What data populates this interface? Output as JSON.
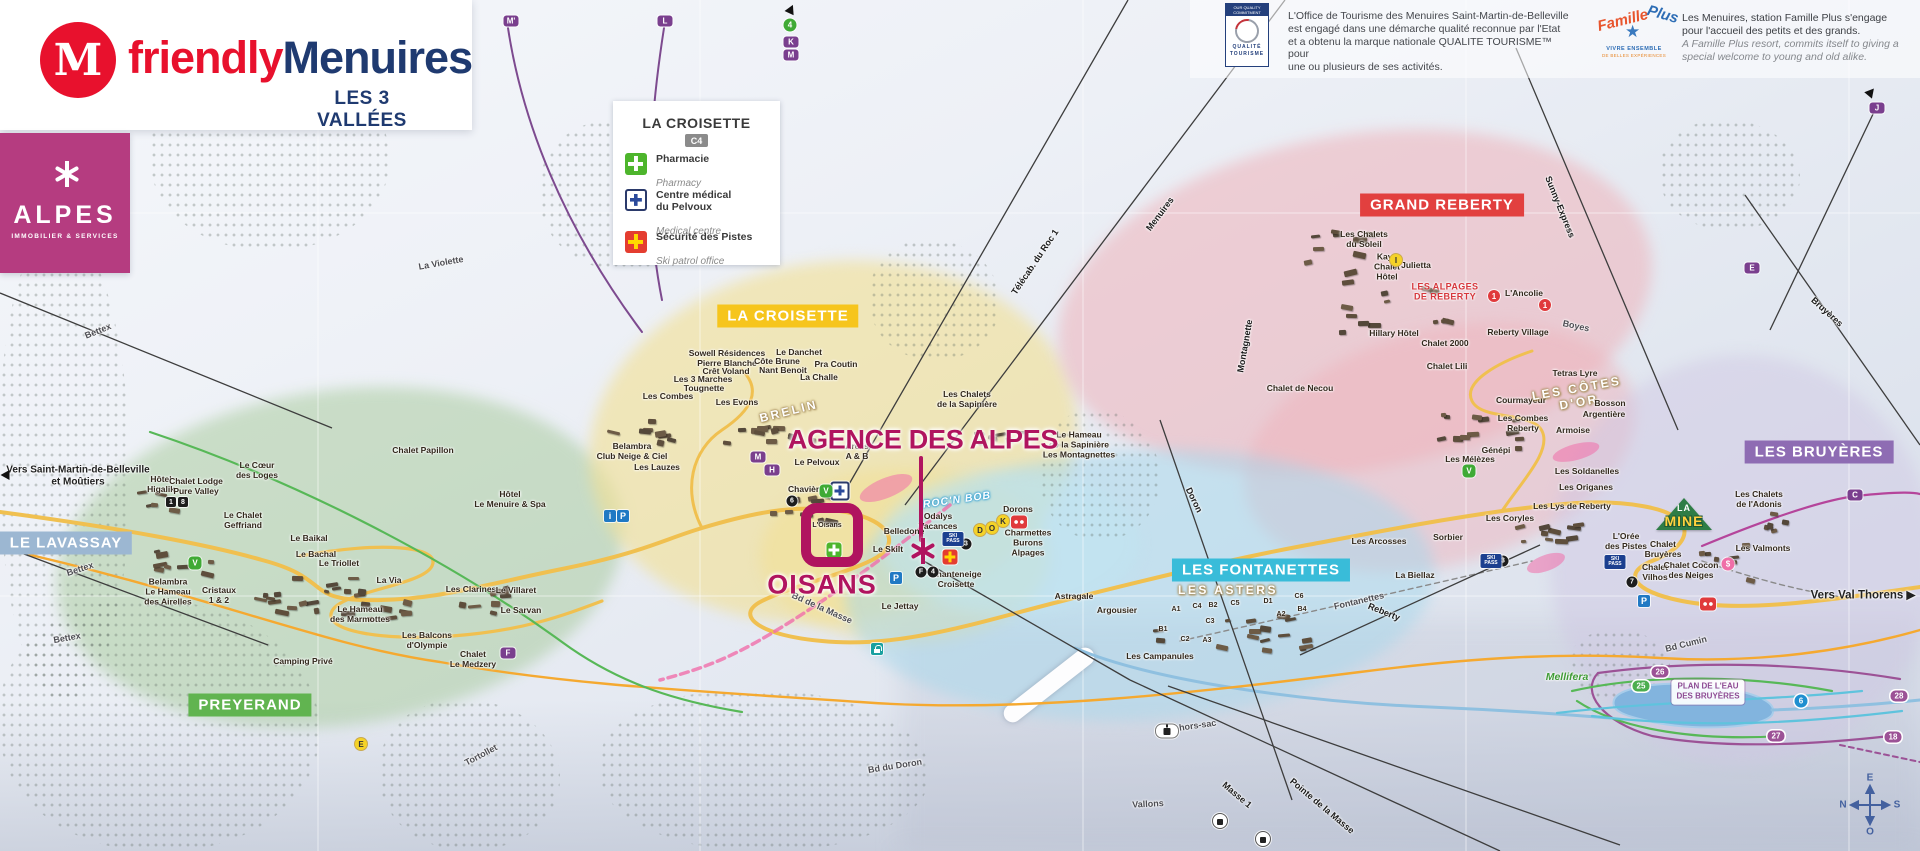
{
  "header": {
    "brand_icon": "M",
    "brand_red": "friendly",
    "brand_blue": "Menuires",
    "tagline": "LES 3 VALLÉES"
  },
  "alpes": {
    "name": "ALPES",
    "sub": "IMMOBILIER & SERVICES"
  },
  "legend": {
    "title": "LA CROISETTE",
    "ref": "C4",
    "items": [
      {
        "label": "Pharmacie",
        "sub": "Pharmacy"
      },
      {
        "label": "Centre médical\ndu Pelvoux",
        "sub": "Medical centre"
      },
      {
        "label": "Sécurité des Pistes",
        "sub": "Ski patrol office"
      }
    ]
  },
  "quality": {
    "logo_top": "OUR QUALITY\nCOMMITMENT",
    "logo_bottom": "QUALITÉ\nTOURISME",
    "text": "L'Office de Tourisme des Menuires Saint-Martin-de-Belleville\nest engagé dans une démarche qualité reconnue par l'Etat\net a obtenu la marque nationale QUALITE TOURISME™ pour\nune ou plusieurs de ses activités."
  },
  "famille": {
    "arc1": "Famille",
    "arc2": "Plus",
    "star": "★",
    "sub1": "VIVRE ENSEMBLE",
    "sub2": "DE BELLES EXPÉRIENCES",
    "fr": "Les Menuires, station Famille Plus s'engage\npour l'accueil des petits et des grands.",
    "en": "A Famille Plus resort, commits itself to giving a\nspecial welcome to young and old alike."
  },
  "callout": {
    "agency": "AGENCE DES ALPES",
    "residence": "OISANS"
  },
  "la_mine": {
    "l1": "LA",
    "l2": "MINE"
  },
  "plan_eau": {
    "t": "PLAN DE L'EAU\nDES BRUYÈRES"
  },
  "compass": {
    "top": "E",
    "right": "S",
    "bottom": "O",
    "left": "N"
  },
  "map": {
    "regions": [
      {
        "t": "LA CROISETTE",
        "x": 788,
        "y": 316,
        "bg": "#f6c51d"
      },
      {
        "t": "GRAND REBERTY",
        "x": 1442,
        "y": 205,
        "bg": "#e2403f"
      },
      {
        "t": "LES BRUYÈRES",
        "x": 1819,
        "y": 452,
        "bg": "#8e6cb3"
      },
      {
        "t": "LES FONTANETTES",
        "x": 1261,
        "y": 570,
        "bg": "#39bcd9"
      },
      {
        "t": "PREYERAND",
        "x": 250,
        "y": 705,
        "bg": "#61b450"
      },
      {
        "t": "LE LAVASSAY",
        "x": 66,
        "y": 543,
        "bg": "#9cb7d2"
      }
    ],
    "labels": [
      {
        "t": "Vers Saint-Martin-de-Belleville\net Moûtiers",
        "x": 78,
        "y": 476,
        "c": "dest",
        "s": 10
      },
      {
        "t": "Vers Val Thorens ▶",
        "x": 1863,
        "y": 596,
        "c": "dest"
      },
      {
        "t": "Hôtel\nHigalik",
        "x": 161,
        "y": 485
      },
      {
        "t": "Chalet Lodge\nPure Valley",
        "x": 196,
        "y": 487
      },
      {
        "t": "Le Cœur\ndes Loges",
        "x": 257,
        "y": 471
      },
      {
        "t": "Le Chalet\nGeffriand",
        "x": 243,
        "y": 521
      },
      {
        "t": "Le Baikal",
        "x": 309,
        "y": 539
      },
      {
        "t": "Belambra\nLe Hameau\ndes Airelles",
        "x": 168,
        "y": 592
      },
      {
        "t": "Cristaux\n1 & 2",
        "x": 219,
        "y": 596
      },
      {
        "t": "Le Bachal",
        "x": 316,
        "y": 555
      },
      {
        "t": "Le Triollet",
        "x": 339,
        "y": 564
      },
      {
        "t": "La Via",
        "x": 389,
        "y": 581
      },
      {
        "t": "Le Hameau\ndes Marmottes",
        "x": 360,
        "y": 615
      },
      {
        "t": "Les Balcons\nd'Olympie",
        "x": 427,
        "y": 641
      },
      {
        "t": "Chalet\nLe Medzery",
        "x": 473,
        "y": 660
      },
      {
        "t": "Les Clarines",
        "x": 471,
        "y": 590
      },
      {
        "t": "Le Villaret",
        "x": 516,
        "y": 591
      },
      {
        "t": "Le Sarvan",
        "x": 521,
        "y": 611
      },
      {
        "t": "Camping Privé",
        "x": 303,
        "y": 662
      },
      {
        "t": "Chalet Papillon",
        "x": 423,
        "y": 451
      },
      {
        "t": "Hôtel\nLe Menuire & Spa",
        "x": 510,
        "y": 500
      },
      {
        "t": "Belambra\nClub Neige & Ciel",
        "x": 632,
        "y": 452
      },
      {
        "t": "Les Lauzes",
        "x": 657,
        "y": 468
      },
      {
        "t": "Sowell Résidences\nPierre Blanche",
        "x": 727,
        "y": 359
      },
      {
        "t": "Crêt Voland",
        "x": 726,
        "y": 372
      },
      {
        "t": "Les 3 Marches",
        "x": 703,
        "y": 380
      },
      {
        "t": "Tougnette",
        "x": 704,
        "y": 389
      },
      {
        "t": "Les Combes",
        "x": 668,
        "y": 397
      },
      {
        "t": "Les Evons",
        "x": 737,
        "y": 403
      },
      {
        "t": "Le Danchet",
        "x": 799,
        "y": 353
      },
      {
        "t": "Côte Brune",
        "x": 777,
        "y": 362
      },
      {
        "t": "Nant Benoit",
        "x": 783,
        "y": 371
      },
      {
        "t": "Pra Coutin",
        "x": 836,
        "y": 365
      },
      {
        "t": "La Challe",
        "x": 819,
        "y": 378
      },
      {
        "t": "BRELIN",
        "x": 789,
        "y": 412,
        "c": "outline",
        "r": -14
      },
      {
        "t": "Le Pelvoux",
        "x": 817,
        "y": 463
      },
      {
        "t": "Arelis\nA & B",
        "x": 857,
        "y": 452
      },
      {
        "t": "Chavière",
        "x": 806,
        "y": 490
      },
      {
        "t": "L'Oisans",
        "x": 827,
        "y": 526,
        "s": 7
      },
      {
        "t": "Odalys\nVacances",
        "x": 938,
        "y": 522
      },
      {
        "t": "ROC'N BOB",
        "x": 957,
        "y": 500,
        "c": "bluestroke",
        "r": -8
      },
      {
        "t": "Dorons",
        "x": 1018,
        "y": 510
      },
      {
        "t": "Charmettes\nBurons\nAlpages",
        "x": 1028,
        "y": 543
      },
      {
        "t": "Chanteneige\nCroisette",
        "x": 956,
        "y": 580
      },
      {
        "t": "Belledone",
        "x": 904,
        "y": 532
      },
      {
        "t": "Le Skilt",
        "x": 888,
        "y": 550
      },
      {
        "t": "Le Jettay",
        "x": 900,
        "y": 607
      },
      {
        "t": "Astragale",
        "x": 1074,
        "y": 597
      },
      {
        "t": "Argousier",
        "x": 1117,
        "y": 611
      },
      {
        "t": "Les Campanules",
        "x": 1160,
        "y": 657
      },
      {
        "t": "Salle hors-sac",
        "x": 1186,
        "y": 727,
        "c": "road",
        "r": -8
      },
      {
        "t": "LES ASTERS",
        "x": 1228,
        "y": 591,
        "c": "outline"
      },
      {
        "t": "Les Arcosses",
        "x": 1379,
        "y": 542
      },
      {
        "t": "La Biellaz",
        "x": 1415,
        "y": 576
      },
      {
        "t": "Le Hameau\nde la Sapinière\nLes Montagnettes",
        "x": 1079,
        "y": 445
      },
      {
        "t": "Les Chalets\nde la Sapinière",
        "x": 967,
        "y": 400
      },
      {
        "t": "Les Chalets\ndu Soleil",
        "x": 1364,
        "y": 240
      },
      {
        "t": "Kaya\nChalet\nHôtel",
        "x": 1387,
        "y": 267
      },
      {
        "t": "Julietta",
        "x": 1416,
        "y": 266
      },
      {
        "t": "LES ALPAGES\nDE REBERTY",
        "x": 1445,
        "y": 292,
        "c": "red"
      },
      {
        "t": "L'Ancolie",
        "x": 1524,
        "y": 294
      },
      {
        "t": "Hillary Hôtel",
        "x": 1394,
        "y": 334
      },
      {
        "t": "Chalet 2000",
        "x": 1445,
        "y": 344
      },
      {
        "t": "Reberty Village",
        "x": 1518,
        "y": 333
      },
      {
        "t": "Chalet Lili",
        "x": 1447,
        "y": 367
      },
      {
        "t": "Chalet de Necou",
        "x": 1300,
        "y": 389
      },
      {
        "t": "Tetras Lyre",
        "x": 1575,
        "y": 374
      },
      {
        "t": "Courmayeur",
        "x": 1521,
        "y": 401
      },
      {
        "t": "LES CÔTES\nD'OR",
        "x": 1578,
        "y": 396,
        "c": "outline",
        "r": -10
      },
      {
        "t": "Bosson",
        "x": 1610,
        "y": 404
      },
      {
        "t": "Argentière",
        "x": 1604,
        "y": 415
      },
      {
        "t": "Les Combes\nReberty",
        "x": 1523,
        "y": 424
      },
      {
        "t": "Armoise",
        "x": 1573,
        "y": 431
      },
      {
        "t": "Génépi",
        "x": 1496,
        "y": 451
      },
      {
        "t": "Les Mélèzes",
        "x": 1470,
        "y": 460
      },
      {
        "t": "Les Soldanelles",
        "x": 1587,
        "y": 472
      },
      {
        "t": "Les Origanes",
        "x": 1586,
        "y": 488
      },
      {
        "t": "Les Lys de Reberty",
        "x": 1572,
        "y": 507
      },
      {
        "t": "Les Coryles",
        "x": 1510,
        "y": 519
      },
      {
        "t": "Sorbier",
        "x": 1448,
        "y": 538
      },
      {
        "t": "L'Orée\ndes Pistes",
        "x": 1626,
        "y": 542
      },
      {
        "t": "Chalet\nBruyères",
        "x": 1663,
        "y": 550
      },
      {
        "t": "Chalet\nVilhos",
        "x": 1655,
        "y": 573
      },
      {
        "t": "Chalet Cocon\ndes Neiges",
        "x": 1691,
        "y": 571
      },
      {
        "t": "Les Chalets\nde l'Adonis",
        "x": 1759,
        "y": 500
      },
      {
        "t": "Les Valmonts",
        "x": 1763,
        "y": 549
      },
      {
        "t": "Mellifera",
        "x": 1567,
        "y": 677,
        "c": "green"
      },
      {
        "t": "A1",
        "x": 1176,
        "y": 610,
        "c": "tiny"
      },
      {
        "t": "C4",
        "x": 1197,
        "y": 607,
        "c": "tiny"
      },
      {
        "t": "B2",
        "x": 1213,
        "y": 606,
        "c": "tiny"
      },
      {
        "t": "C5",
        "x": 1235,
        "y": 604,
        "c": "tiny"
      },
      {
        "t": "D1",
        "x": 1268,
        "y": 602,
        "c": "tiny"
      },
      {
        "t": "C6",
        "x": 1299,
        "y": 597,
        "c": "tiny"
      },
      {
        "t": "A2",
        "x": 1281,
        "y": 615,
        "c": "tiny"
      },
      {
        "t": "B4",
        "x": 1302,
        "y": 610,
        "c": "tiny"
      },
      {
        "t": "C3",
        "x": 1210,
        "y": 622,
        "c": "tiny"
      },
      {
        "t": "B1",
        "x": 1163,
        "y": 630,
        "c": "tiny"
      },
      {
        "t": "C2",
        "x": 1185,
        "y": 640,
        "c": "tiny"
      },
      {
        "t": "A3",
        "x": 1207,
        "y": 641,
        "c": "tiny"
      },
      {
        "t": "La Violette",
        "x": 441,
        "y": 263,
        "c": "road",
        "r": -10
      },
      {
        "t": "Bettex",
        "x": 98,
        "y": 331,
        "c": "road",
        "r": -22
      },
      {
        "t": "Bettex",
        "x": 80,
        "y": 569,
        "c": "road",
        "r": -18
      },
      {
        "t": "Bettex",
        "x": 67,
        "y": 638,
        "c": "road",
        "r": -10
      },
      {
        "t": "Tortollet",
        "x": 481,
        "y": 755,
        "c": "road",
        "r": -28
      },
      {
        "t": "Bd du Doron",
        "x": 895,
        "y": 766,
        "c": "road",
        "r": -9
      },
      {
        "t": "Vallons",
        "x": 1148,
        "y": 804,
        "c": "road",
        "r": -3
      },
      {
        "t": "Bd Cumin",
        "x": 1686,
        "y": 644,
        "c": "road",
        "r": -14
      },
      {
        "t": "Bd de la Masse",
        "x": 822,
        "y": 608,
        "c": "road",
        "r": 24
      },
      {
        "t": "Boyes",
        "x": 1576,
        "y": 326,
        "c": "road",
        "r": 12
      },
      {
        "t": "Bruyères",
        "x": 1827,
        "y": 312,
        "c": "lift",
        "r": 42
      },
      {
        "t": "Sunny-Express",
        "x": 1560,
        "y": 207,
        "c": "lift",
        "r": 68
      },
      {
        "t": "Menuires",
        "x": 1160,
        "y": 214,
        "c": "lift",
        "r": -53
      },
      {
        "t": "Télécab. du Roc 1",
        "x": 1035,
        "y": 262,
        "c": "lift",
        "r": -56
      },
      {
        "t": "Montagnette",
        "x": 1245,
        "y": 346,
        "c": "lift",
        "r": -80
      },
      {
        "t": "Doron",
        "x": 1194,
        "y": 500,
        "c": "lift",
        "r": 64
      },
      {
        "t": "Masse 1",
        "x": 1237,
        "y": 795,
        "c": "lift",
        "r": 40
      },
      {
        "t": "Pointe de la Masse",
        "x": 1322,
        "y": 806,
        "c": "lift",
        "r": 40
      },
      {
        "t": "Fontanettes",
        "x": 1359,
        "y": 601,
        "c": "road",
        "r": -13
      },
      {
        "t": "Reberty",
        "x": 1384,
        "y": 612,
        "c": "lift",
        "r": 22
      }
    ],
    "badges": [
      {
        "t": "M'",
        "x": 511,
        "y": 21,
        "k": "pp"
      },
      {
        "t": "L",
        "x": 665,
        "y": 21,
        "k": "pp"
      },
      {
        "t": "4",
        "x": 790,
        "y": 25,
        "k": "cg"
      },
      {
        "t": "K",
        "x": 791,
        "y": 42,
        "k": "pp"
      },
      {
        "t": "M",
        "x": 791,
        "y": 55,
        "k": "pp"
      },
      {
        "t": "",
        "x": 791,
        "y": 9,
        "k": "tri",
        "r": 25
      },
      {
        "t": "J",
        "x": 1877,
        "y": 108,
        "k": "pp"
      },
      {
        "t": "",
        "x": 1871,
        "y": 92,
        "k": "tri",
        "r": 40
      },
      {
        "t": "E",
        "x": 1752,
        "y": 268,
        "k": "pp"
      },
      {
        "t": "F",
        "x": 508,
        "y": 653,
        "k": "pp"
      },
      {
        "t": "C",
        "x": 1855,
        "y": 495,
        "k": "pp"
      },
      {
        "t": "M",
        "x": 758,
        "y": 457,
        "k": "pp"
      },
      {
        "t": "H",
        "x": 772,
        "y": 470,
        "k": "pp"
      },
      {
        "t": "",
        "x": 5,
        "y": 475,
        "k": "tri",
        "r": -90
      },
      {
        "t": "D",
        "x": 980,
        "y": 530,
        "k": "cy"
      },
      {
        "t": "O",
        "x": 992,
        "y": 528,
        "k": "cy"
      },
      {
        "t": "K",
        "x": 1003,
        "y": 521,
        "k": "cy"
      },
      {
        "t": "E",
        "x": 361,
        "y": 744,
        "k": "cy"
      },
      {
        "t": "I",
        "x": 1396,
        "y": 260,
        "k": "cy"
      },
      {
        "t": "1",
        "x": 1494,
        "y": 296,
        "k": "cr"
      },
      {
        "t": "1",
        "x": 1545,
        "y": 305,
        "k": "cr"
      },
      {
        "t": "3",
        "x": 966,
        "y": 544,
        "k": "cb"
      },
      {
        "t": "F",
        "x": 921,
        "y": 572,
        "k": "cb"
      },
      {
        "t": "4",
        "x": 933,
        "y": 572,
        "k": "cb"
      },
      {
        "t": "6",
        "x": 792,
        "y": 501,
        "k": "cb"
      },
      {
        "t": "7",
        "x": 1632,
        "y": 582,
        "k": "cb"
      },
      {
        "t": "3",
        "x": 1503,
        "y": 561,
        "k": "cb"
      },
      {
        "t": "1",
        "x": 171,
        "y": 502,
        "k": "sb"
      },
      {
        "t": "8",
        "x": 183,
        "y": 502,
        "k": "sb"
      },
      {
        "t": "i",
        "x": 610,
        "y": 516,
        "k": "qb"
      },
      {
        "t": "P",
        "x": 623,
        "y": 516,
        "k": "qb"
      },
      {
        "t": "P",
        "x": 896,
        "y": 578,
        "k": "qb"
      },
      {
        "t": "P",
        "x": 1644,
        "y": 601,
        "k": "qb"
      },
      {
        "t": "SKI\nPASS",
        "x": 953,
        "y": 539,
        "k": "sp"
      },
      {
        "t": "SKI\nPASS",
        "x": 1491,
        "y": 561,
        "k": "sp"
      },
      {
        "t": "SKI\nPASS",
        "x": 1615,
        "y": 562,
        "k": "sp"
      },
      {
        "t": "",
        "x": 834,
        "y": 550,
        "k": "xg"
      },
      {
        "t": "",
        "x": 840,
        "y": 491,
        "k": "xb"
      },
      {
        "t": "",
        "x": 950,
        "y": 557,
        "k": "xr"
      },
      {
        "t": "$",
        "x": 1728,
        "y": 564,
        "k": "pk"
      },
      {
        "t": "",
        "x": 1019,
        "y": 522,
        "k": "rb"
      },
      {
        "t": "",
        "x": 1708,
        "y": 591,
        "k": "rb"
      },
      {
        "t": "",
        "x": 1167,
        "y": 705,
        "k": "go"
      },
      {
        "t": "",
        "x": 1220,
        "y": 780,
        "k": "gc"
      },
      {
        "t": "",
        "x": 1263,
        "y": 782,
        "k": "gc"
      },
      {
        "t": "V",
        "x": 195,
        "y": 563,
        "k": "vg"
      },
      {
        "t": "V",
        "x": 826,
        "y": 491,
        "k": "vg"
      },
      {
        "t": "V",
        "x": 1469,
        "y": 471,
        "k": "vg"
      },
      {
        "t": "",
        "x": 877,
        "y": 576,
        "k": "lk"
      },
      {
        "t": "26",
        "x": 1660,
        "y": 672,
        "k": "rp"
      },
      {
        "t": "27",
        "x": 1776,
        "y": 736,
        "k": "rp"
      },
      {
        "t": "28",
        "x": 1899,
        "y": 696,
        "k": "rp"
      },
      {
        "t": "18",
        "x": 1893,
        "y": 737,
        "k": "rp"
      },
      {
        "t": "25",
        "x": 1641,
        "y": 686,
        "k": "rg"
      },
      {
        "t": "6",
        "x": 1801,
        "y": 701,
        "k": "cB"
      }
    ]
  }
}
